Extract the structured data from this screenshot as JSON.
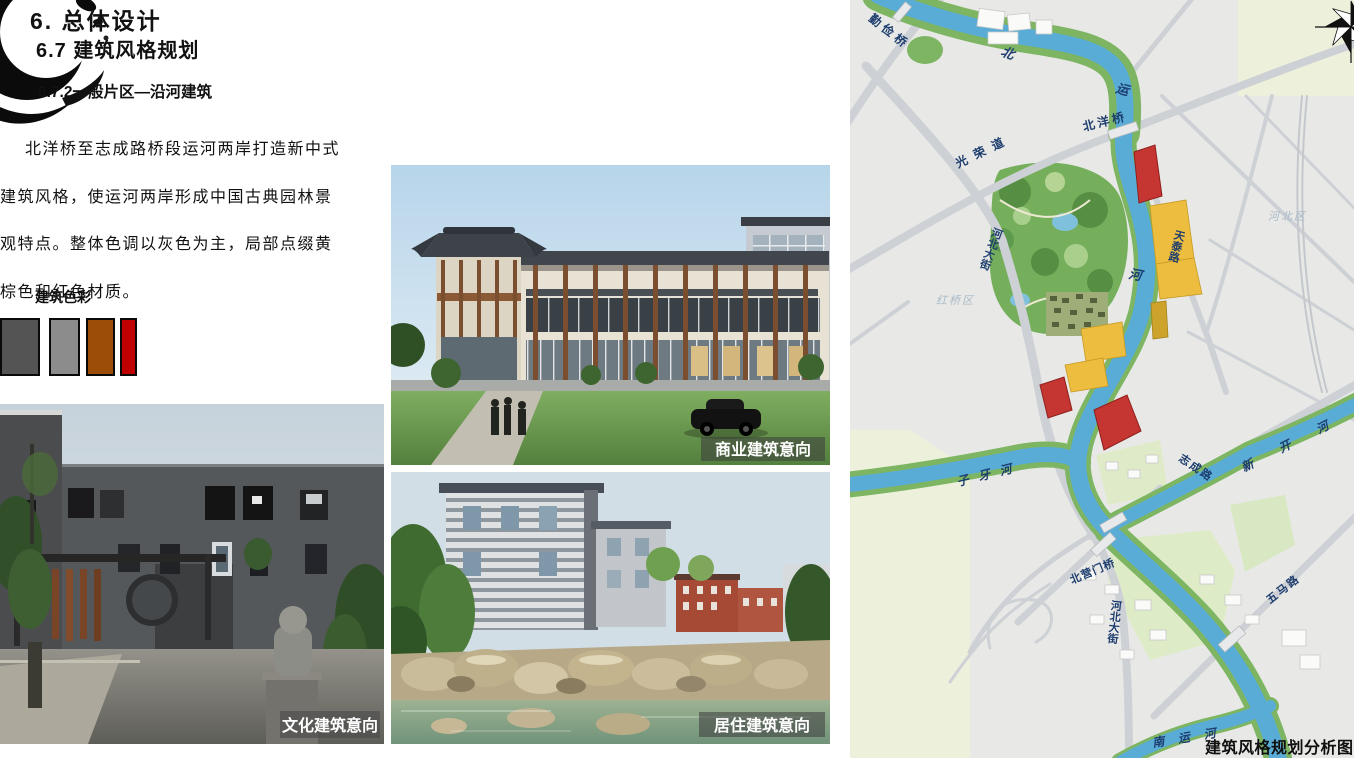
{
  "slide": {
    "heading1": "6.  总体设计",
    "heading2": "6.7 建筑风格规划",
    "heading3": "6.7.2一般片区—沿河建筑",
    "paragraph": [
      "北洋桥至志成路桥段运河两岸打造新中式",
      "建筑风格，使运河两岸形成中国古典园林景",
      "观特点。整体色调以灰色为主，局部点缀黄",
      "棕色和红色材质。"
    ],
    "palette_title": "建筑色彩",
    "palette": [
      {
        "name": "dark-gray",
        "hex": "#545454"
      },
      {
        "name": "medium-gray",
        "hex": "#8C8C8C"
      },
      {
        "name": "brown",
        "hex": "#9C4E08"
      },
      {
        "name": "red",
        "hex": "#C00000"
      }
    ]
  },
  "photos": {
    "culture_caption": "文化建筑意向",
    "commercial_caption": "商业建筑意向",
    "residential_caption": "居住建筑意向"
  },
  "map": {
    "caption": "建筑风格规划分析图",
    "district_hongqiao": "红桥区",
    "district_hebei": "河北区",
    "river_char_bei": "北",
    "river_char_yun": "运",
    "river_char_he": "河",
    "river_ziya": "子牙河",
    "river_xinkai": "新开河",
    "river_nanyun": "南运河",
    "bridge_qinjian": "勤俭桥",
    "bridge_beiyang": "北洋桥",
    "bridge_beiyingmen": "北营门桥",
    "road_guangrong": "光荣道",
    "road_hebei_north": "河北大街",
    "road_hebei_south": "河北大街",
    "road_tiantai": "天泰路",
    "road_zhicheng": "志成路",
    "road_wuma": "五马路"
  },
  "colors": {
    "map_background": "#EDF1DB",
    "river_blue": "#58ACD6",
    "park_green": "#75AF5C",
    "zone_red": "#C53632",
    "zone_yellow": "#EDBD3F",
    "zone_olive": "#CDA32B",
    "map_label_navy": "#1D3D6E"
  }
}
